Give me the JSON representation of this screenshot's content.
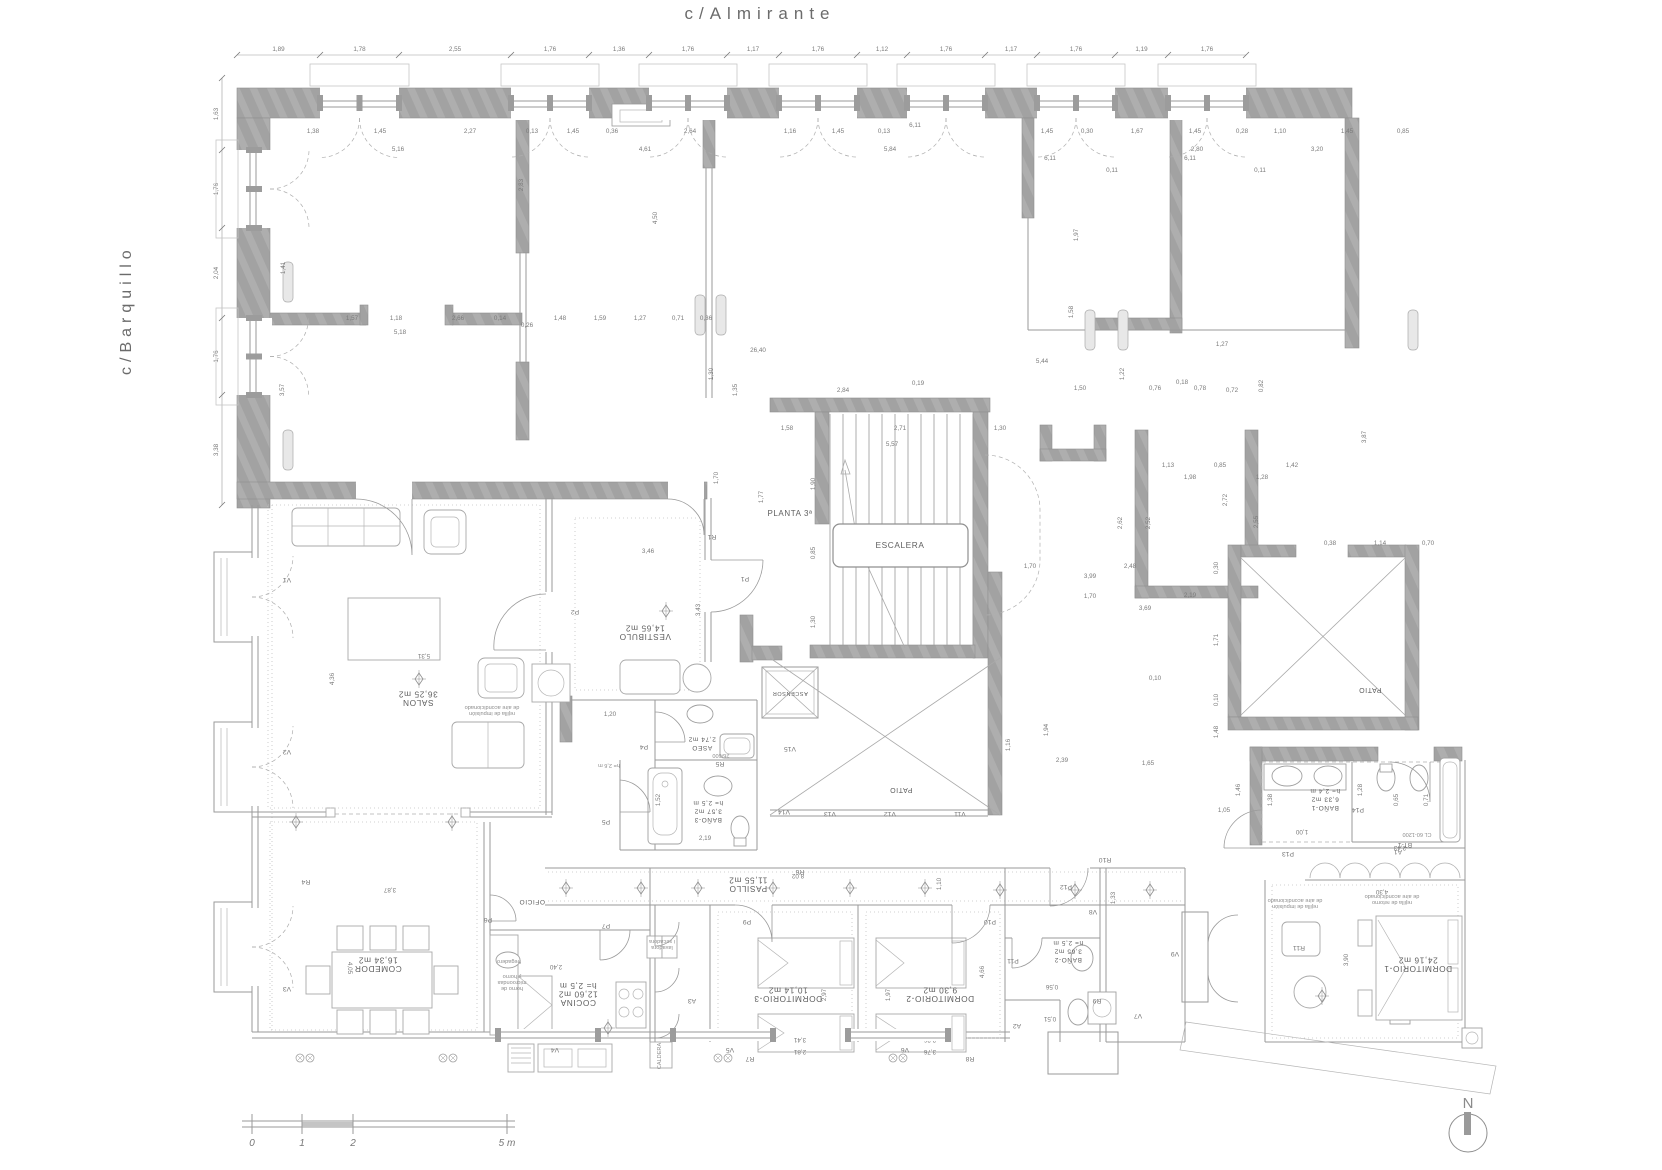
{
  "streets": {
    "top": "c/Almirante",
    "left": "c/Barquillo"
  },
  "plan": {
    "floor_label": "PLANTA 3ª"
  },
  "north": {
    "label": "N"
  },
  "scalebar": {
    "labels": [
      "0",
      "1",
      "2",
      "5 m"
    ]
  },
  "colors": {
    "wall": "#a2a2a2",
    "line": "#9a9a9a",
    "text": "#6b6b6b",
    "dim": "#7a7a7a"
  },
  "rooms": [
    {
      "name": "SALON",
      "area": "36,25 m2",
      "x": 418,
      "y": 700,
      "rot": 180
    },
    {
      "name": "COMEDOR",
      "area": "16,34 m2",
      "x": 378,
      "y": 966,
      "rot": 180
    },
    {
      "name": "COCINA",
      "area": "12,60 m2",
      "extra": "h= 2,5 m",
      "x": 578,
      "y": 1000,
      "rot": 180
    },
    {
      "name": "VESTIBULO",
      "area": "14,65 m2",
      "x": 645,
      "y": 634,
      "rot": 180
    },
    {
      "name": "ASEO",
      "area": "2,74 m2",
      "x": 702,
      "y": 746,
      "rot": 180,
      "size": 6.5
    },
    {
      "name": "BAÑO-3",
      "area": "3,57 m2",
      "extra": "h= 2,5 m",
      "x": 708,
      "y": 818,
      "rot": 180,
      "size": 6.5
    },
    {
      "name": "PASILLO",
      "area": "11,55 m2",
      "x": 748,
      "y": 886,
      "rot": 180
    },
    {
      "name": "DORMITORIO-3",
      "area": "10,14 m2",
      "x": 788,
      "y": 996,
      "rot": 180
    },
    {
      "name": "DORMITORIO-2",
      "area": "9,30 m2",
      "x": 940,
      "y": 996,
      "rot": 180
    },
    {
      "name": "BAÑO-2",
      "area": "3,65 m2",
      "extra": "h= 2,5 m",
      "x": 1068,
      "y": 958,
      "rot": 180,
      "size": 6.5
    },
    {
      "name": "DORMITORIO-1",
      "area": "24,16 m2",
      "x": 1418,
      "y": 966,
      "rot": 180
    },
    {
      "name": "BAÑO-1",
      "area": "6,33 m2",
      "extra": "h= 2,4 m",
      "x": 1325,
      "y": 806,
      "rot": 180,
      "size": 6.5
    },
    {
      "name": "OFICIO",
      "x": 532,
      "y": 900,
      "rot": 180,
      "size": 6.5
    },
    {
      "name": "ESCALERA",
      "x": 900,
      "y": 548,
      "rot": 0
    },
    {
      "name": "ASCENSOR",
      "x": 790,
      "y": 692,
      "rot": 180,
      "size": 5.5
    },
    {
      "name": "PATIO",
      "x": 901,
      "y": 788,
      "rot": 180,
      "size": 7
    },
    {
      "name": "PATIO",
      "x": 1370,
      "y": 688,
      "rot": 180,
      "size": 7
    },
    {
      "name": "PLANTA 3ª",
      "x": 790,
      "y": 516,
      "rot": 0,
      "size": 8
    }
  ],
  "dim_chains": [
    {
      "dir": "h",
      "line": 55,
      "ticks": [
        237,
        320,
        399,
        511,
        589,
        649,
        727,
        779,
        857,
        907,
        985,
        1037,
        1115,
        1168,
        1246
      ],
      "values": [
        "1,89",
        "1,78",
        "2,55",
        "1,76",
        "1,36",
        "1,76",
        "1,17",
        "1,76",
        "1,12",
        "1,76",
        "1,17",
        "1,76",
        "1,19",
        "1,76"
      ]
    },
    {
      "dir": "v",
      "line": 222,
      "ticks": [
        78,
        150,
        228,
        318,
        395,
        505
      ],
      "values": [
        "1,63",
        "1,76",
        "2,04",
        "1,76",
        "3,38"
      ]
    }
  ],
  "dim_labels": [
    [
      "1,38",
      313,
      133
    ],
    [
      "1,45",
      380,
      133
    ],
    [
      "2,27",
      470,
      133
    ],
    [
      "0,13",
      532,
      133
    ],
    [
      "1,45",
      573,
      133
    ],
    [
      "0,36",
      612,
      133
    ],
    [
      "2,64",
      690,
      133
    ],
    [
      "1,16",
      790,
      133
    ],
    [
      "1,45",
      838,
      133
    ],
    [
      "0,13",
      884,
      133
    ],
    [
      "6,11",
      915,
      127
    ],
    [
      "5,16",
      398,
      151
    ],
    [
      "4,61",
      645,
      151
    ],
    [
      "5,84",
      890,
      151
    ],
    [
      "1,45",
      1047,
      133
    ],
    [
      "0,30",
      1087,
      133
    ],
    [
      "1,67",
      1137,
      133
    ],
    [
      "1,45",
      1195,
      133
    ],
    [
      "0,28",
      1242,
      133
    ],
    [
      "1,10",
      1280,
      133
    ],
    [
      "1,45",
      1347,
      133
    ],
    [
      "0,85",
      1403,
      133
    ],
    [
      "2,80",
      1197,
      151
    ],
    [
      "3,20",
      1317,
      151
    ],
    [
      "6,11",
      1050,
      160
    ],
    [
      "6,11",
      1190,
      160
    ],
    [
      "0,11",
      1112,
      172
    ],
    [
      "0,11",
      1260,
      172
    ],
    [
      "2,83",
      523,
      185,
      -90
    ],
    [
      "4,50",
      657,
      218,
      -90
    ],
    [
      "1,41",
      285,
      268,
      -90
    ],
    [
      "3,57",
      284,
      390,
      -90
    ],
    [
      "1,97",
      1078,
      235,
      -90
    ],
    [
      "1,58",
      1073,
      312,
      -90
    ],
    [
      "1,57",
      352,
      320
    ],
    [
      "1,18",
      396,
      320
    ],
    [
      "2,66",
      458,
      320
    ],
    [
      "0,14",
      500,
      320
    ],
    [
      "5,18",
      400,
      334
    ],
    [
      "0,26",
      527,
      327
    ],
    [
      "1,48",
      560,
      320
    ],
    [
      "1,59",
      600,
      320
    ],
    [
      "1,27",
      640,
      320
    ],
    [
      "0,71",
      678,
      320
    ],
    [
      "0,36",
      706,
      320
    ],
    [
      "26,40",
      758,
      352
    ],
    [
      "5,44",
      1042,
      363
    ],
    [
      "2,84",
      843,
      392
    ],
    [
      "0,19",
      918,
      385
    ],
    [
      "1,50",
      1080,
      390
    ],
    [
      "1,22",
      1124,
      374,
      -90
    ],
    [
      "0,76",
      1155,
      390
    ],
    [
      "0,18",
      1182,
      384
    ],
    [
      "0,78",
      1200,
      390
    ],
    [
      "0,72",
      1232,
      392
    ],
    [
      "0,82",
      1263,
      386,
      -90
    ],
    [
      "1,27",
      1222,
      346
    ],
    [
      "1,35",
      737,
      390,
      -90
    ],
    [
      "1,30",
      713,
      374,
      -90
    ],
    [
      "1,58",
      787,
      430
    ],
    [
      "2,71",
      900,
      430
    ],
    [
      "1,30",
      1000,
      430
    ],
    [
      "5,57",
      892,
      446
    ],
    [
      "1,70",
      718,
      478,
      -90
    ],
    [
      "1,77",
      763,
      497,
      -90
    ],
    [
      "1,90",
      815,
      484,
      -90
    ],
    [
      "0,85",
      815,
      553,
      -90
    ],
    [
      "1,30",
      815,
      622,
      -90
    ],
    [
      "1,13",
      1168,
      467
    ],
    [
      "0,85",
      1220,
      467
    ],
    [
      "1,98",
      1190,
      479
    ],
    [
      "1,42",
      1292,
      467
    ],
    [
      "1,28",
      1262,
      479
    ],
    [
      "2,72",
      1227,
      500,
      -90
    ],
    [
      "2,62",
      1122,
      523,
      -90
    ],
    [
      "2,52",
      1150,
      523,
      -90
    ],
    [
      "2,55",
      1258,
      522,
      -90
    ],
    [
      "1,70",
      1090,
      598
    ],
    [
      "2,19",
      1190,
      597
    ],
    [
      "3,69",
      1145,
      610
    ],
    [
      "3,87",
      1366,
      437,
      -90
    ],
    [
      "0,38",
      1330,
      545
    ],
    [
      "1,14",
      1380,
      545
    ],
    [
      "0,70",
      1428,
      545
    ],
    [
      "0,30",
      1218,
      568,
      -90
    ],
    [
      "1,71",
      1218,
      640,
      -90
    ],
    [
      "0,10",
      1218,
      700,
      -90
    ],
    [
      "1,48",
      1218,
      732,
      -90
    ],
    [
      "1,70",
      1030,
      568
    ],
    [
      "3,99",
      1090,
      578
    ],
    [
      "2,48",
      1130,
      568
    ],
    [
      "1,94",
      1048,
      730,
      -90
    ],
    [
      "2,39",
      1062,
      762
    ],
    [
      "1,65",
      1148,
      765
    ],
    [
      "0,10",
      1155,
      680
    ],
    [
      "1,16",
      1010,
      745,
      -90
    ],
    [
      "5,31",
      424,
      654,
      180
    ],
    [
      "4,36",
      334,
      679,
      -90
    ],
    [
      "3,46",
      648,
      553
    ],
    [
      "3,43",
      700,
      610,
      -90
    ],
    [
      "1,20",
      610,
      716
    ],
    [
      "2,19",
      705,
      840
    ],
    [
      "1,52",
      660,
      800,
      -90
    ],
    [
      "3,87",
      390,
      888,
      180
    ],
    [
      "4,05",
      348,
      968,
      90
    ],
    [
      "2,40",
      556,
      965,
      180
    ],
    [
      "3,60",
      560,
      1035,
      180
    ],
    [
      "2,97",
      826,
      995,
      -90
    ],
    [
      "1,97",
      890,
      995,
      -90
    ],
    [
      "3,41",
      800,
      1038,
      180
    ],
    [
      "2,81",
      800,
      1050,
      180
    ],
    [
      "3,36",
      930,
      1038,
      180
    ],
    [
      "3,76",
      930,
      1050,
      180
    ],
    [
      "4,66",
      984,
      972,
      -90
    ],
    [
      "1,10",
      941,
      884,
      -90
    ],
    [
      "0,56",
      1052,
      985,
      180
    ],
    [
      "0,51",
      1050,
      1017,
      180
    ],
    [
      "1,33",
      1115,
      898,
      -90
    ],
    [
      "8,02",
      798,
      874,
      180
    ],
    [
      "4,30",
      1382,
      890,
      180
    ],
    [
      "3,90",
      1348,
      960,
      -90
    ],
    [
      "1,46",
      1240,
      790,
      -90
    ],
    [
      "1,38",
      1272,
      800,
      -90
    ],
    [
      "1,28",
      1362,
      790,
      -90
    ],
    [
      "0,65",
      1398,
      800,
      -90
    ],
    [
      "0,71",
      1428,
      800,
      -90
    ],
    [
      "2,43",
      1400,
      846,
      180
    ],
    [
      "1,00",
      1302,
      830,
      180
    ],
    [
      "1,05",
      1224,
      812
    ]
  ],
  "tags": [
    [
      "P1",
      745,
      577
    ],
    [
      "P2",
      575,
      610
    ],
    [
      "P4",
      644,
      745
    ],
    [
      "P5",
      606,
      820
    ],
    [
      "P6",
      488,
      918
    ],
    [
      "P7",
      606,
      924
    ],
    [
      "P9",
      747,
      920
    ],
    [
      "P10",
      990,
      920
    ],
    [
      "P11",
      1013,
      959
    ],
    [
      "P12",
      1066,
      885
    ],
    [
      "P13",
      1288,
      852
    ],
    [
      "P14",
      1358,
      808
    ],
    [
      "R1",
      712,
      535
    ],
    [
      "R4",
      306,
      880
    ],
    [
      "R5",
      720,
      762
    ],
    [
      "R6",
      800,
      870
    ],
    [
      "R7",
      750,
      1057
    ],
    [
      "R8",
      970,
      1057
    ],
    [
      "R9",
      1097,
      999
    ],
    [
      "R10",
      1105,
      858
    ],
    [
      "R11",
      1299,
      946
    ],
    [
      "A1",
      1398,
      850
    ],
    [
      "A2",
      1017,
      1024
    ],
    [
      "A3",
      692,
      999
    ],
    [
      "V1",
      287,
      578
    ],
    [
      "V2",
      287,
      750
    ],
    [
      "V3",
      287,
      987
    ],
    [
      "V4",
      555,
      1048
    ],
    [
      "V5",
      730,
      1048
    ],
    [
      "V6",
      905,
      1048
    ],
    [
      "V7",
      1138,
      1014
    ],
    [
      "V8",
      1093,
      910
    ],
    [
      "V9",
      1175,
      952
    ],
    [
      "V11",
      960,
      812
    ],
    [
      "V12",
      890,
      812
    ],
    [
      "V13",
      830,
      812
    ],
    [
      "V14",
      784,
      810
    ],
    [
      "V15",
      790,
      747
    ],
    [
      "BT-1",
      1405,
      843
    ]
  ],
  "annotations": [
    [
      "rejilla de impulsión\nde aire acondicionado",
      492,
      712,
      180
    ],
    [
      "rejilla de impulsión\nde aire acondicionado",
      1295,
      905,
      180
    ],
    [
      "rejilla de retorno\nde aire acondicionado",
      1392,
      901,
      180
    ],
    [
      "fregadero",
      509,
      960,
      180
    ],
    [
      "lavadora\ni secadora",
      662,
      946,
      180
    ],
    [
      "horno de\nmicroondas\ny horno",
      512,
      987,
      180
    ],
    [
      "h= 2,6 m",
      609,
      764,
      180
    ],
    [
      "CL 60-1200",
      1417,
      833,
      180
    ],
    [
      "26/600",
      721,
      754,
      180
    ],
    [
      "CALDERA",
      661,
      1056,
      -90
    ]
  ]
}
